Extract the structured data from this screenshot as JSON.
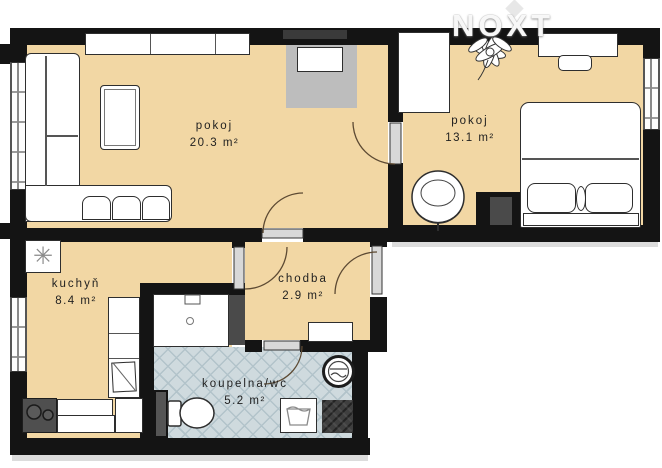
{
  "watermark": {
    "text": "NOXT"
  },
  "rooms": [
    {
      "name": "pokoj",
      "area": "20.3 m²"
    },
    {
      "name": "pokoj",
      "area": "13.1 m²"
    },
    {
      "name": "kuchyň",
      "area": "8.4 m²"
    },
    {
      "name": "chodba",
      "area": "2.9 m²"
    },
    {
      "name": "koupelna/wc",
      "area": "5.2 m²"
    }
  ],
  "symbols": {
    "fan": "✳"
  },
  "colors": {
    "floor": "#f2d7a4",
    "bath_tile": "#cfdade",
    "wall": "#141414",
    "furniture_outline": "#2e2e2e",
    "tv": "#3a3a3a",
    "stove": "#4f4f4f",
    "shaft": "#3f3f3f",
    "door_arc": "#5d4a33"
  }
}
